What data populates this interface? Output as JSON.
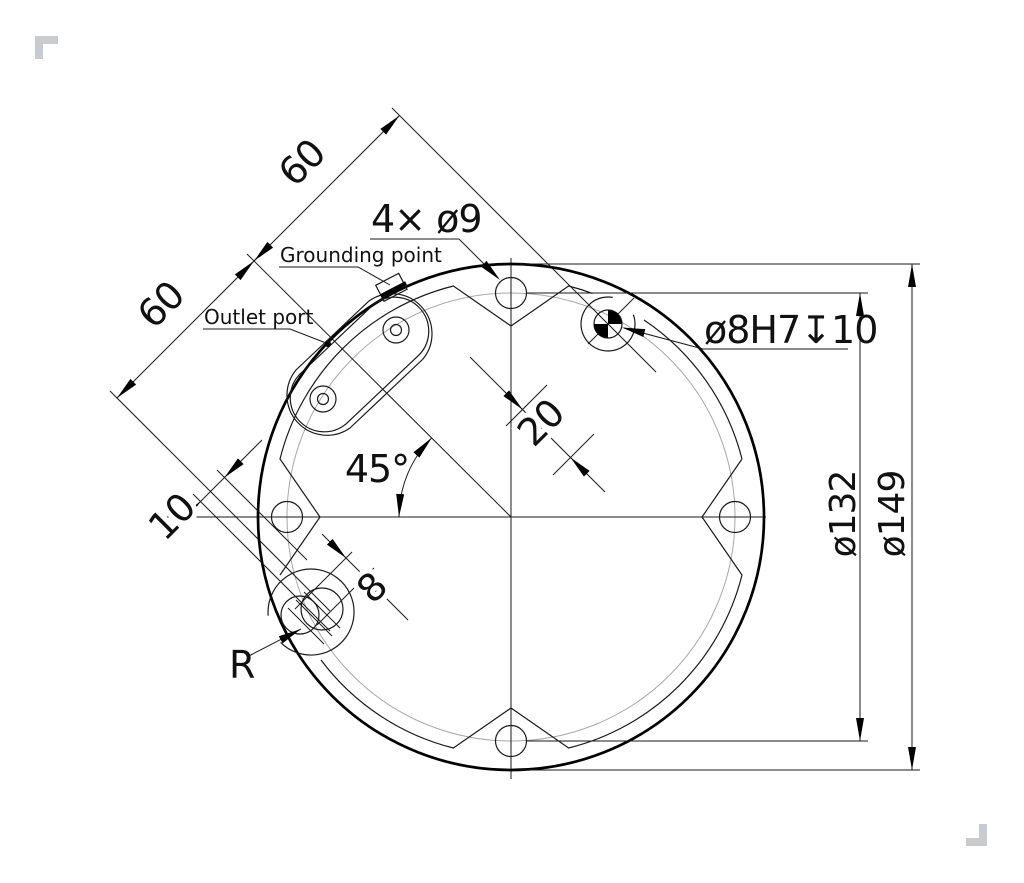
{
  "drawing": {
    "type": "technical-dimension-drawing",
    "part": "circular mounting flange, bottom view",
    "labels": {
      "grounding_point": "Grounding point",
      "outlet_port": "Outlet port",
      "holes_callout": "4× ø9",
      "dowel_callout": "ø8H7↧10",
      "radius_label": "R"
    },
    "dimensions": {
      "chain_upper": "60",
      "chain_lower": "60",
      "dowel_offset": "20",
      "angle": "45°",
      "slot_offset": "10",
      "slot_width": "8",
      "bolt_circle_dia": "ø132",
      "outer_dia": "ø149"
    },
    "colors": {
      "line": "#1a1a1a",
      "outline": "#000000",
      "construction_gray": "#a8a8a8",
      "corner_mark_gray": "#c9cbcc",
      "background": "#ffffff"
    }
  }
}
